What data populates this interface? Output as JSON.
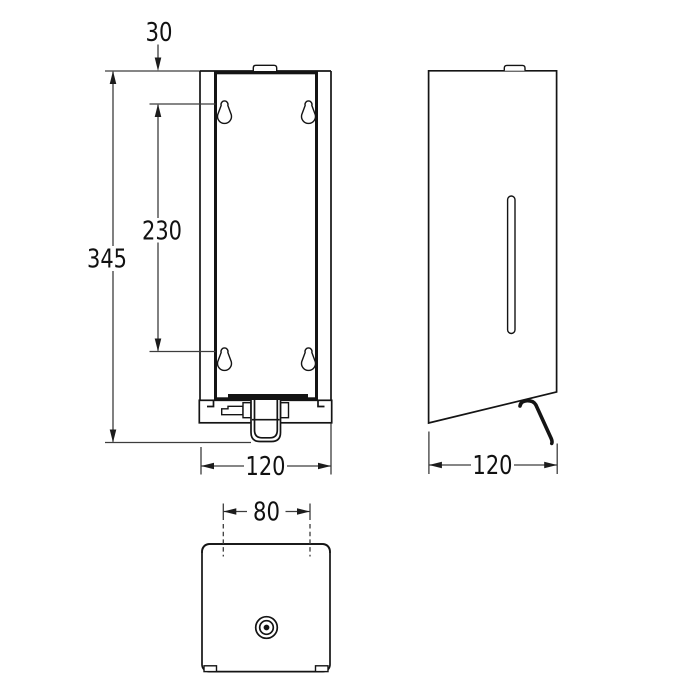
{
  "dimensions": {
    "front": {
      "top_to_hole": "30",
      "overall_height": "345",
      "hole_spacing": "230",
      "width": "120"
    },
    "side": {
      "depth": "120"
    },
    "bottom": {
      "nozzle_span": "80"
    }
  },
  "colors": {
    "background": "#ffffff",
    "object_line": "#141414",
    "dimension_line": "#3d3d3d",
    "text": "#111111"
  }
}
